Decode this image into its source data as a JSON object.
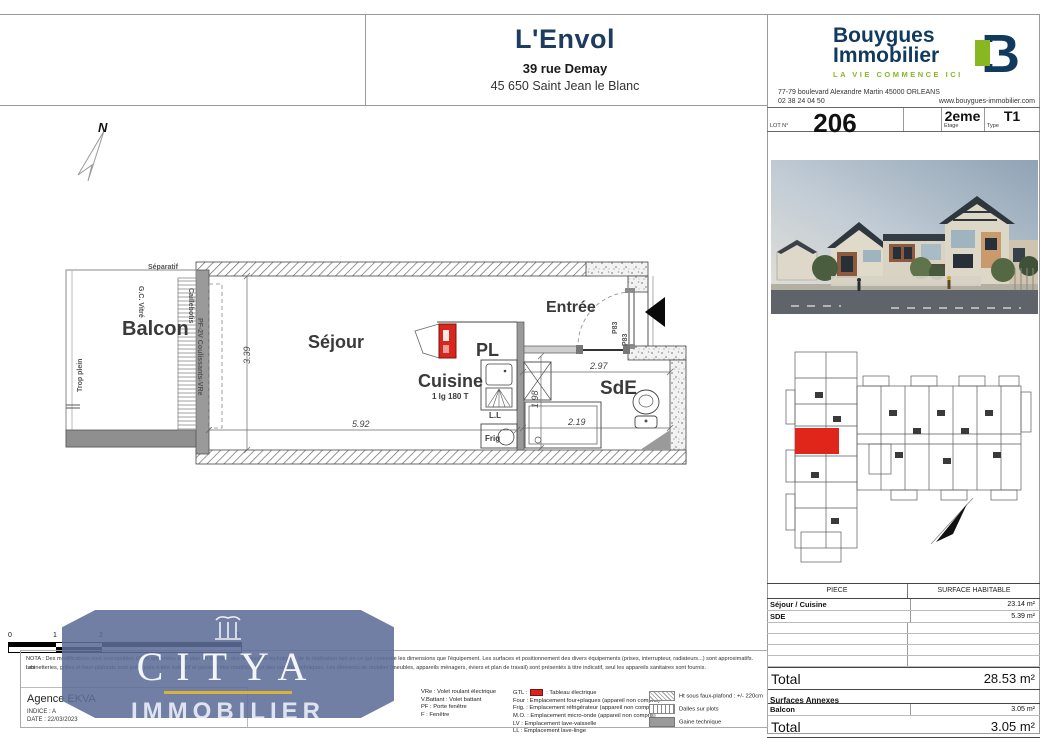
{
  "header": {
    "title": "L'Envol",
    "address_line1": "39 rue Demay",
    "address_line2": "45 650 Saint Jean le Blanc"
  },
  "brand": {
    "name_line1": "Bouygues",
    "name_line2": "Immobilier",
    "tagline": "LA VIE COMMENCE ICI",
    "address": "77-79 boulevard Alexandre Martin 45000 ORLEANS",
    "phone": "02 38 24 04 50",
    "website": "www.bouygues-immobilier.com",
    "navy": "#123a5e",
    "green": "#87b822"
  },
  "lot": {
    "number": "206",
    "number_label": "LOT N°",
    "etage_value": "2eme",
    "etage_label": "Etage",
    "type_value": "T1",
    "type_label": "Type"
  },
  "plan": {
    "rooms": {
      "balcon": "Balcon",
      "sejour": "Séjour",
      "cuisine": "Cuisine",
      "cuisine_sub": "1 lg 180 T",
      "pl": "PL",
      "entree": "Entrée",
      "sde": "SdE"
    },
    "annotations": {
      "separatif": "Séparatif",
      "gc_vitre": "G.C. Vitré",
      "trop_plein": "Trop plein",
      "caillebotis": "Caillebotis",
      "coulissants": "PF-2V Coulissants-VRe",
      "door1": "P83",
      "door2": "P83",
      "ll": "L.L",
      "frig": "Frig",
      "north": "N"
    },
    "dimensions": {
      "sejour_w": "5.92",
      "sejour_h": "3.39",
      "sde_w": "2.97",
      "sde_w2": "2.19",
      "sde_h": "1.98"
    },
    "highlight_color": "#d9261c"
  },
  "sitemap": {
    "highlight_color": "#e0251b"
  },
  "surface_table": {
    "col1_header": "PIECE",
    "col2_header": "SURFACE HABITABLE",
    "rows": [
      {
        "piece": "Séjour / Cuisine",
        "surface": "23.14 m²"
      },
      {
        "piece": "SDE",
        "surface": "5.39 m²"
      }
    ],
    "total_label": "Total",
    "total_value": "28.53 m²",
    "annexes_label": "Surfaces Annexes",
    "annex_rows": [
      {
        "piece": "Balcon",
        "surface": "3.05 m²"
      }
    ],
    "annex_total_label": "Total",
    "annex_total_value": "3.05 m²",
    "nota": "NOTA : La surface des placards est incluse dans celle des pièces attenantes."
  },
  "legend": {
    "nota_line1": "NOTA : Des modifications sont susceptibles d'être apportées à ce plan en fonction des nécessités techniques de la réalisation tant en ce qui concerne les dimensions que l'équipement. Les surfaces et positionnement des divers équipements (prises, interrupteur, radiateurs...) sont approximatifs. Les",
    "nota_line2": "robinetteries, grilles et faux-plafonds sont préfigurés à titre indicatif et peuvent être modifiés pour des raisons techniques. Les éléments de mobilier (meubles, appareils ménagers, éviers et plan de travail) sont présentés à titre indicatif, seul les appareils sanitaires sont fournis.",
    "col1": [
      "VRe : Volet roulant électrique",
      "V.Battant : Volet battant",
      "PF : Porte fenêtre",
      "F : Fenêtre"
    ],
    "gtl_label": "GTL :",
    "gtl_desc": ": Tableau électrique",
    "col2": [
      "Four : Emplacement four+plaques (appareil non compris)",
      "Frig. : Emplacement réfrigérateur (appareil non compris)",
      "M.O. : Emplacement micro-onde (appareil non compris)",
      "LV : Emplacement lave-vaisselle",
      "LL : Emplacement lave-linge"
    ],
    "col3": [
      "Ht sous faux-plafond : +/- 220cm",
      "Dalles sur plots",
      "Gaine technique"
    ]
  },
  "scalebar": {
    "t0": "0",
    "t1": "1",
    "t2": "2",
    "t5": "5"
  },
  "footer": {
    "agency": "Agence EKVA",
    "indice": "INDICE : A",
    "date": "DATE : 22/03/2023"
  },
  "watermark": {
    "title": "CITYA",
    "subtitle": "IMMOBILIER"
  }
}
